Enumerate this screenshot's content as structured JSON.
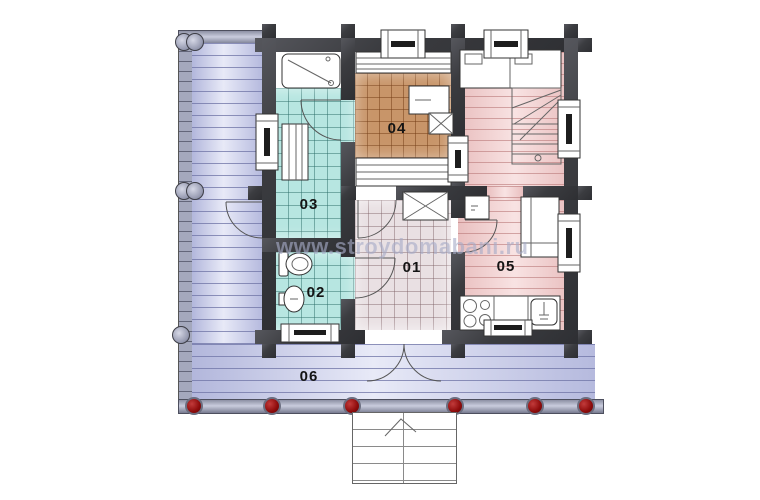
{
  "watermark": {
    "text": "www.stroydomabani.ru"
  },
  "rooms": [
    {
      "number": "01"
    },
    {
      "number": "02"
    },
    {
      "number": "03"
    },
    {
      "number": "04"
    },
    {
      "number": "05"
    },
    {
      "number": "06"
    }
  ],
  "colors": {
    "wall": "#3b3c40",
    "veranda_floor": "#ccd0ee",
    "wet_tile": "#b7e6e1",
    "sauna_tile": "#c89569",
    "hall_tile": "#e9e0e3",
    "wood_floor": "#f4d0d0",
    "porch_edge": "#a4a8bd",
    "column": "#8d0b0b",
    "watermark_color": "#a7acc8"
  }
}
